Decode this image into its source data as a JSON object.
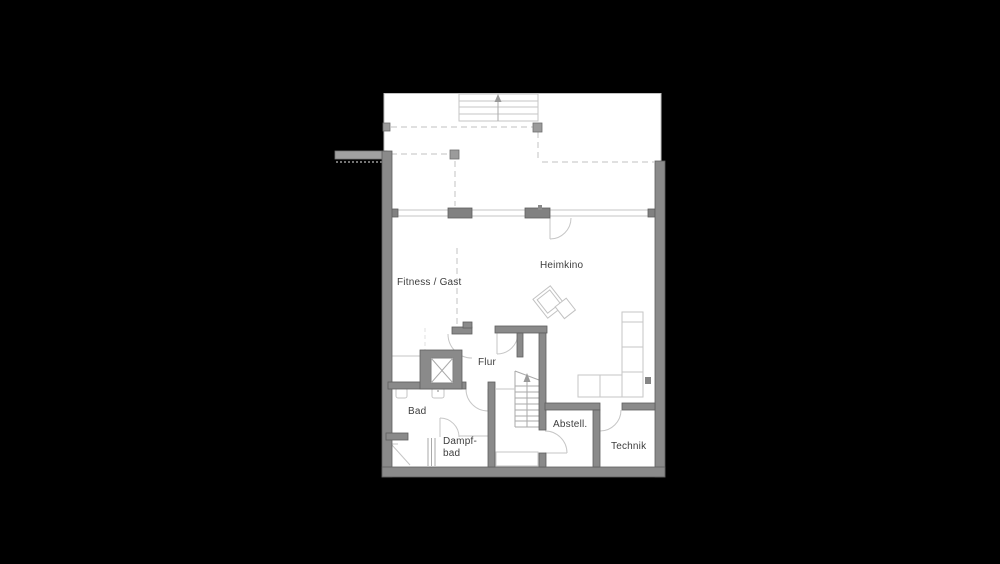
{
  "rooms": {
    "fitness_gast": {
      "label": "Fitness / Gast"
    },
    "heimkino": {
      "label": "Heimkino"
    },
    "flur": {
      "label": "Flur"
    },
    "bad": {
      "label": "Bad"
    },
    "dampfbad": {
      "line1": "Dampf-",
      "line2": "bad"
    },
    "abstell": {
      "label": "Abstell."
    },
    "technik": {
      "label": "Technik"
    }
  },
  "colors": {
    "bg": "#000000",
    "paper": "#ffffff",
    "wall": "#8a8a8a",
    "wall-edge": "#5e5e5e",
    "pier": "#818181",
    "line-light": "#c6c6c6",
    "line-mid": "#aaaaaa",
    "text": "#3d3d3d"
  }
}
